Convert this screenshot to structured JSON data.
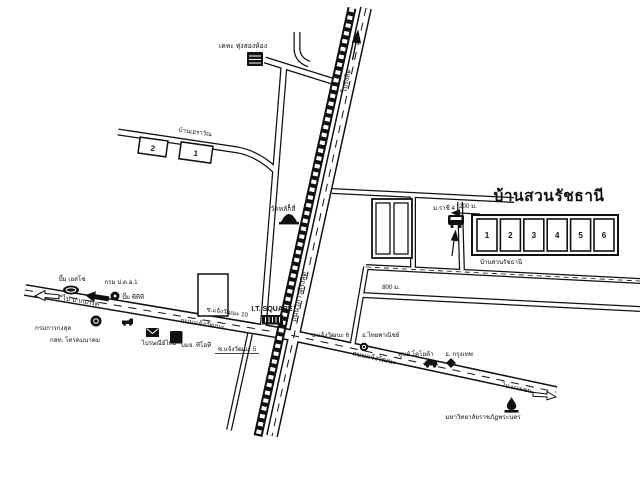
{
  "map": {
    "background": "#ffffff",
    "ink": "#111111",
    "title_color": "#d40f0f"
  },
  "estate": {
    "title_red": "บ้านสวนรัชธานี",
    "name_black": "บ้านสวนรัชธานี",
    "blocks": [
      "1",
      "2",
      "3",
      "4",
      "5",
      "6"
    ],
    "bus_stop": "ม.ราชี 4",
    "dist_200m": "200 ม.",
    "dist_800m": "800 ม."
  },
  "houses": {
    "erawan_label": "บ้านเอราวัณ",
    "numbers": [
      "2",
      "1"
    ]
  },
  "places": {
    "kheha": "เคหะ ทุ่งสองห้อง",
    "wat_lak_si": "วัดหลักสี่",
    "esso": "ปั๊ม เอสโซ่",
    "por_tor_or": "กรม ป.ต.อ.1",
    "ptt": "ปั๊ม พีทีที",
    "consular": "กรมการกงสุล",
    "cat_telecom": "กสท. โทรคมนาคม",
    "thailand_post": "ไปรษณีย์ไทย",
    "tot": "บมจ. ทีโอที",
    "it_square": "I.T. SQUARE",
    "scb_bank": "ธ.ไทยพาณิชย์",
    "toyota": "ศูนย์ โตโยต้า",
    "bangkok_bank": "ธ. กรุงเทพ",
    "university": "มหาวิทยาลัยราชภัฏพระนคร"
  },
  "roads": {
    "chaeng_watthana_left": "ถนนแจ้งวัฒนะ",
    "chaeng_watthana_right": "ถนนแจ้งวัฒนะ",
    "vibhavadi": "ถนนวิภาวดีรังสิต",
    "soi_10": "ซ.แจ้งวัฒนะ 10",
    "soi_5": "ซ.แจ้งวัฒนะ 5",
    "soi_6": "ซ.แจ้งวัฒนะ 6",
    "to_rangsit": "ไปรังสิต",
    "to_pak_kret": "ไป ปากเกร็ด",
    "to_bang_khen": "ไป บางเขน"
  },
  "icons": {
    "tot_phone_glyph": "☎"
  }
}
